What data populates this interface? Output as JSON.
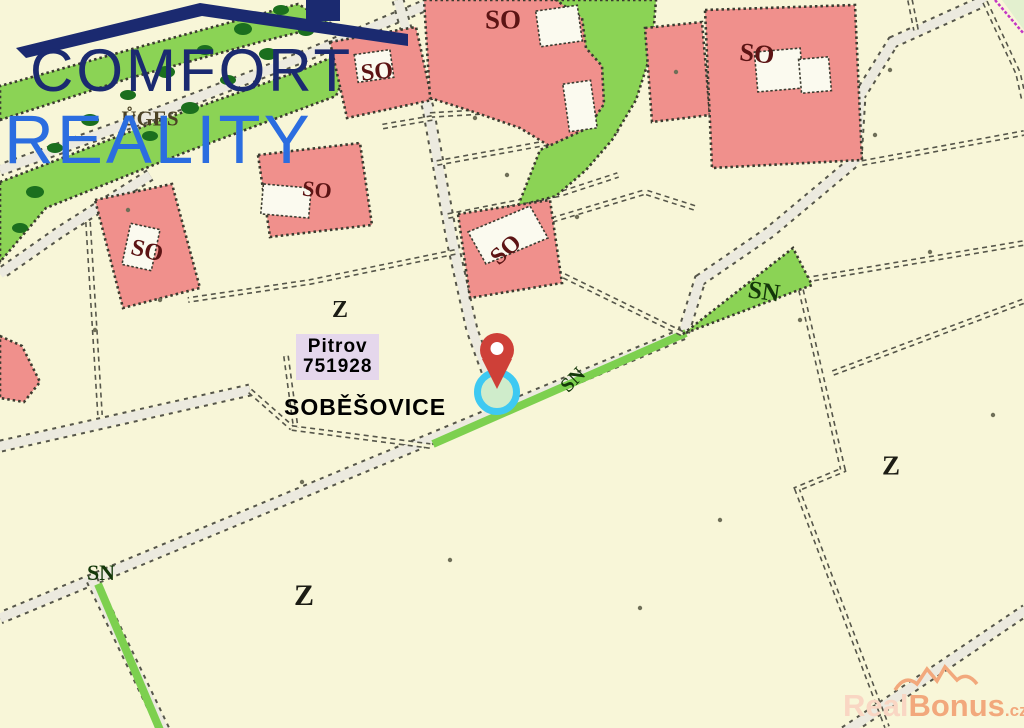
{
  "branding": {
    "line1": "COMFORT",
    "line2": "REALITY",
    "color_primary": "#1b2a70",
    "color_secondary": "#2b6de0"
  },
  "watermark": {
    "real": "Real",
    "bonus": "Bonus",
    "tld": ".cz",
    "color_light": "#f9d6c3",
    "color_main": "#f2a87c"
  },
  "map": {
    "palette": {
      "background": "#f8f6d8",
      "parcel_line": "#56564a",
      "road_fill": "#eceadf",
      "zone_pink": "#f0908c",
      "zone_green": "#8bd355",
      "tree_green": "#1b6f1e",
      "road_green": "#7dd04f",
      "corner_green": "#e3f0cf",
      "boundary_magenta": "#c436c4"
    },
    "label_colors": {
      "so": "#5c1414",
      "z": "#1c1c14",
      "sn": "#14380a",
      "uges": "#4a4124",
      "parcel": "#f261d8",
      "place": "#a81594"
    },
    "labels": {
      "place": "SOBĚŠOVICE",
      "parcel_name": "Pitrov",
      "parcel_number": "751928",
      "underlay_text": "ŮGES"
    },
    "zone_labels": [
      {
        "text": "SO",
        "x": 503,
        "y": 20,
        "rot": 0,
        "size": 27,
        "type": "so"
      },
      {
        "text": "SO",
        "x": 377,
        "y": 72,
        "rot": -6,
        "size": 24,
        "type": "so"
      },
      {
        "text": "SO",
        "x": 147,
        "y": 251,
        "rot": 14,
        "size": 24,
        "type": "so"
      },
      {
        "text": "SO",
        "x": 317,
        "y": 190,
        "rot": 6,
        "size": 22,
        "type": "so"
      },
      {
        "text": "SO",
        "x": 506,
        "y": 250,
        "rot": -42,
        "size": 24,
        "type": "so"
      },
      {
        "text": "SO",
        "x": 757,
        "y": 54,
        "rot": 6,
        "size": 26,
        "type": "so"
      },
      {
        "text": "Z",
        "x": 340,
        "y": 310,
        "rot": 0,
        "size": 24,
        "type": "z"
      },
      {
        "text": "Z",
        "x": 304,
        "y": 596,
        "rot": 0,
        "size": 30,
        "type": "z"
      },
      {
        "text": "Z",
        "x": 891,
        "y": 466,
        "rot": 0,
        "size": 27,
        "type": "z"
      },
      {
        "text": "SN",
        "x": 764,
        "y": 292,
        "rot": 8,
        "size": 25,
        "type": "sn"
      },
      {
        "text": "SN",
        "x": 573,
        "y": 380,
        "rot": -45,
        "size": 20,
        "type": "sn"
      },
      {
        "text": "SN",
        "x": 101,
        "y": 573,
        "rot": 0,
        "size": 22,
        "type": "sn"
      },
      {
        "text": "ŮGES",
        "x": 150,
        "y": 119,
        "rot": 0,
        "size": 21,
        "type": "uges"
      }
    ],
    "marker": {
      "pin_color": "#ce4038",
      "pin_hole": "#ffffff",
      "ring_color": "#3ec9f2",
      "ring_fill": "#cfeccb"
    }
  }
}
